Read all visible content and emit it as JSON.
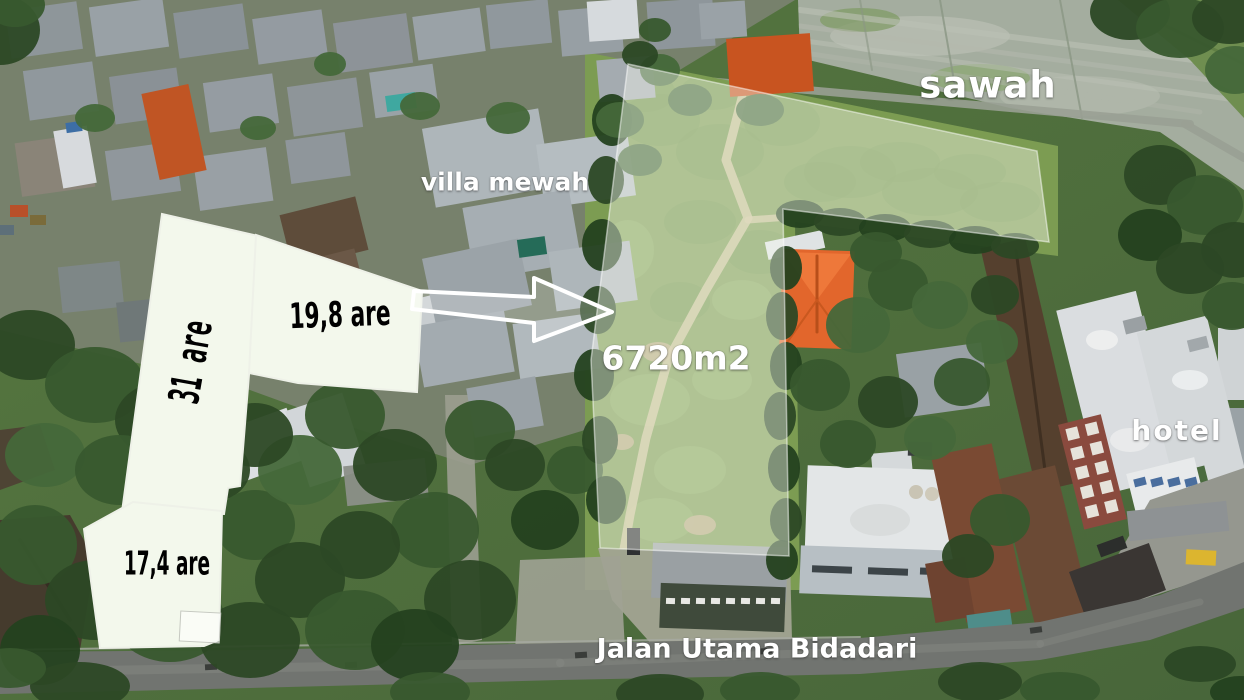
{
  "scene": "aerial drone photo of land for sale",
  "labels": {
    "sawah": "sawah",
    "villa_mewah": "villa mewah",
    "total_area": "6720m2",
    "parcel_large": "31 are",
    "parcel_mid": "19,8 are",
    "parcel_small": "17,4 are",
    "hotel": "hotel",
    "street": "Jalan Utama Bidadari"
  },
  "colors": {
    "parcel_fill": "#f3f8ec",
    "parcel_border": "#eef1e8",
    "land_overlay_fill": "rgba(248,250,240,0.42)",
    "land_overlay_border": "rgba(255,255,255,0.5)",
    "arrow_fill": "rgba(255,255,255,0.22)",
    "arrow_border": "#ffffff",
    "orange_roof": "#e2662c",
    "label_light": "#ffffff",
    "label_dark": "#000000"
  }
}
